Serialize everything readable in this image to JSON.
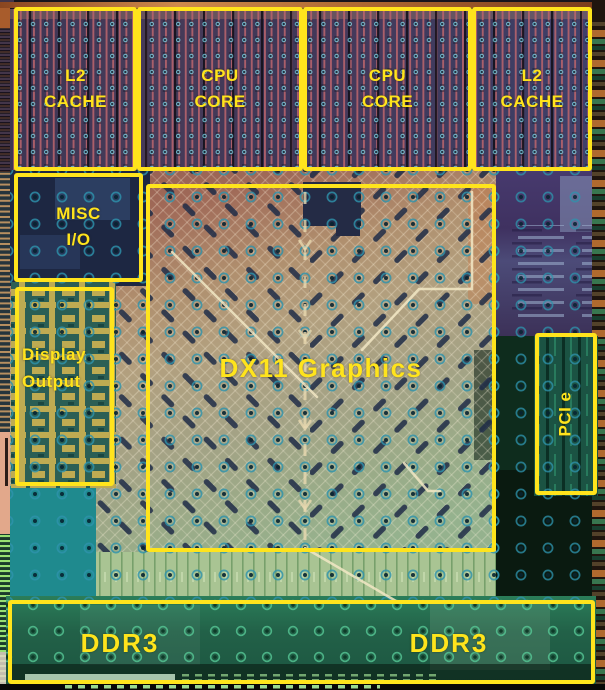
{
  "annotation_color": "#ffe41c",
  "regions": [
    {
      "id": "l2-cache-left",
      "lines": [
        "L2",
        "CACHE"
      ]
    },
    {
      "id": "cpu-core-left",
      "lines": [
        "CPU",
        "CORE"
      ]
    },
    {
      "id": "cpu-core-right",
      "lines": [
        "CPU",
        "CORE"
      ]
    },
    {
      "id": "l2-cache-right",
      "lines": [
        "L2",
        "CACHE"
      ]
    },
    {
      "id": "misc-io",
      "lines": [
        "MISC",
        "I/O"
      ]
    },
    {
      "id": "display-output",
      "lines": [
        "Display",
        "Output"
      ]
    },
    {
      "id": "dx11-graphics",
      "lines": [
        "DX11 Graphics"
      ]
    },
    {
      "id": "pcie",
      "lines": [
        "PCI e"
      ]
    },
    {
      "id": "ddr3-left",
      "lines": [
        "DDR3"
      ]
    },
    {
      "id": "ddr3-right",
      "lines": [
        "DDR3"
      ]
    }
  ]
}
